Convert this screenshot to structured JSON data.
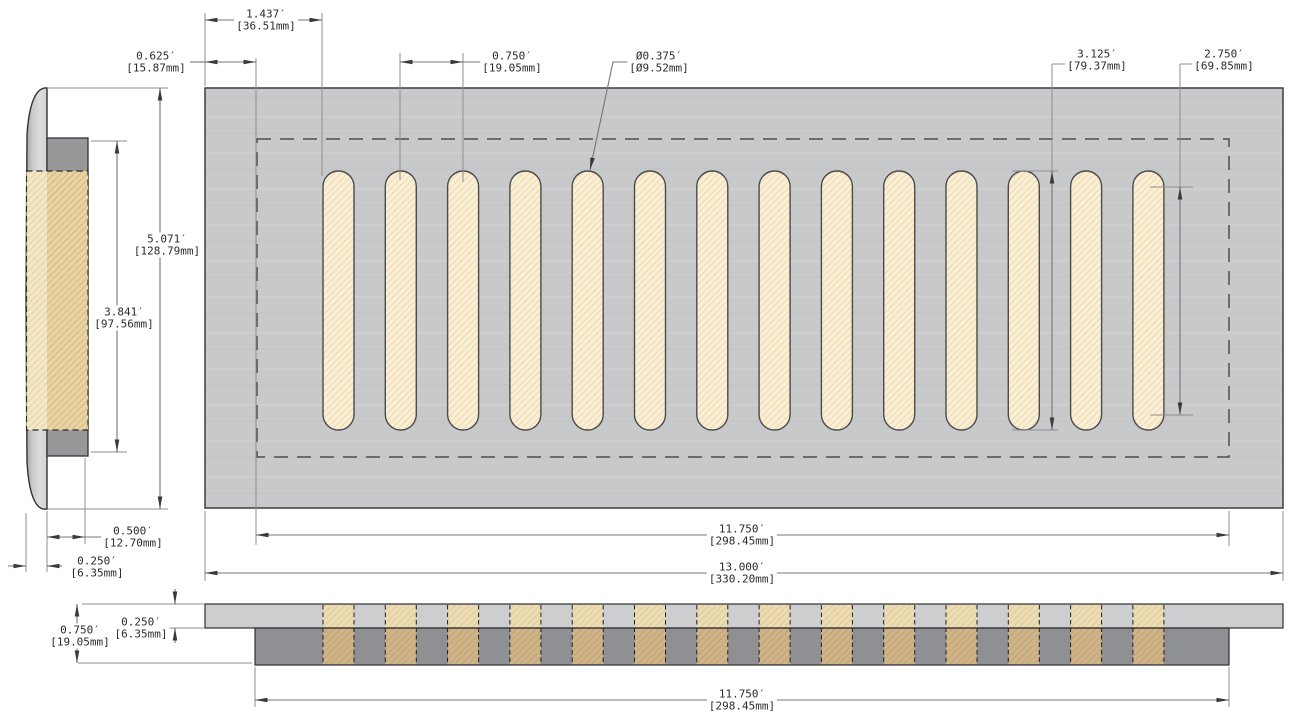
{
  "drawing": {
    "title": "Vent cover dimensioned drawing",
    "views": {
      "side": {
        "label": "side-profile-view"
      },
      "top": {
        "label": "top-plan-view",
        "slot_count": 14
      },
      "section": {
        "label": "front-section-view",
        "slot_count": 14
      }
    },
    "dimensions": {
      "flange_offset_x": {
        "in": "1.437′",
        "mm": "[36.51mm]"
      },
      "duct_inset": {
        "in": "0.625′",
        "mm": "[15.87mm]"
      },
      "slot_pitch": {
        "in": "0.750′",
        "mm": "[19.05mm]"
      },
      "slot_width_dia": {
        "in": "Ø0.375′",
        "mm": "[Ø9.52mm]"
      },
      "slot_length": {
        "in": "3.125′",
        "mm": "[79.37mm]"
      },
      "slot_cc_length": {
        "in": "2.750′",
        "mm": "[69.85mm]"
      },
      "overall_height": {
        "in": "5.071′",
        "mm": "[128.79mm]"
      },
      "duct_height": {
        "in": "3.841′",
        "mm": "[97.56mm]"
      },
      "collar_depth": {
        "in": "0.500′",
        "mm": "[12.70mm]"
      },
      "face_thickness": {
        "in": "0.250′",
        "mm": "[6.35mm]"
      },
      "duct_width": {
        "in": "11.750′",
        "mm": "[298.45mm]"
      },
      "overall_width": {
        "in": "13.000′",
        "mm": "[330.20mm]"
      },
      "section_height": {
        "in": "0.750′",
        "mm": "[19.05mm]"
      },
      "section_face_thickness": {
        "in": "0.250′",
        "mm": "[6.35mm]"
      },
      "section_duct_width": {
        "in": "11.750′",
        "mm": "[298.45mm]"
      }
    },
    "colors": {
      "plate": "#c8c9ca",
      "slot_fill": "#f9efd7",
      "slot_hatch": "#ecca90",
      "section_top_plate": "#cdcecf",
      "section_body": "#8f9093",
      "collar": "#97989a",
      "hatch_tan": "#e8d3a2",
      "line": "#3a3a3a"
    }
  }
}
